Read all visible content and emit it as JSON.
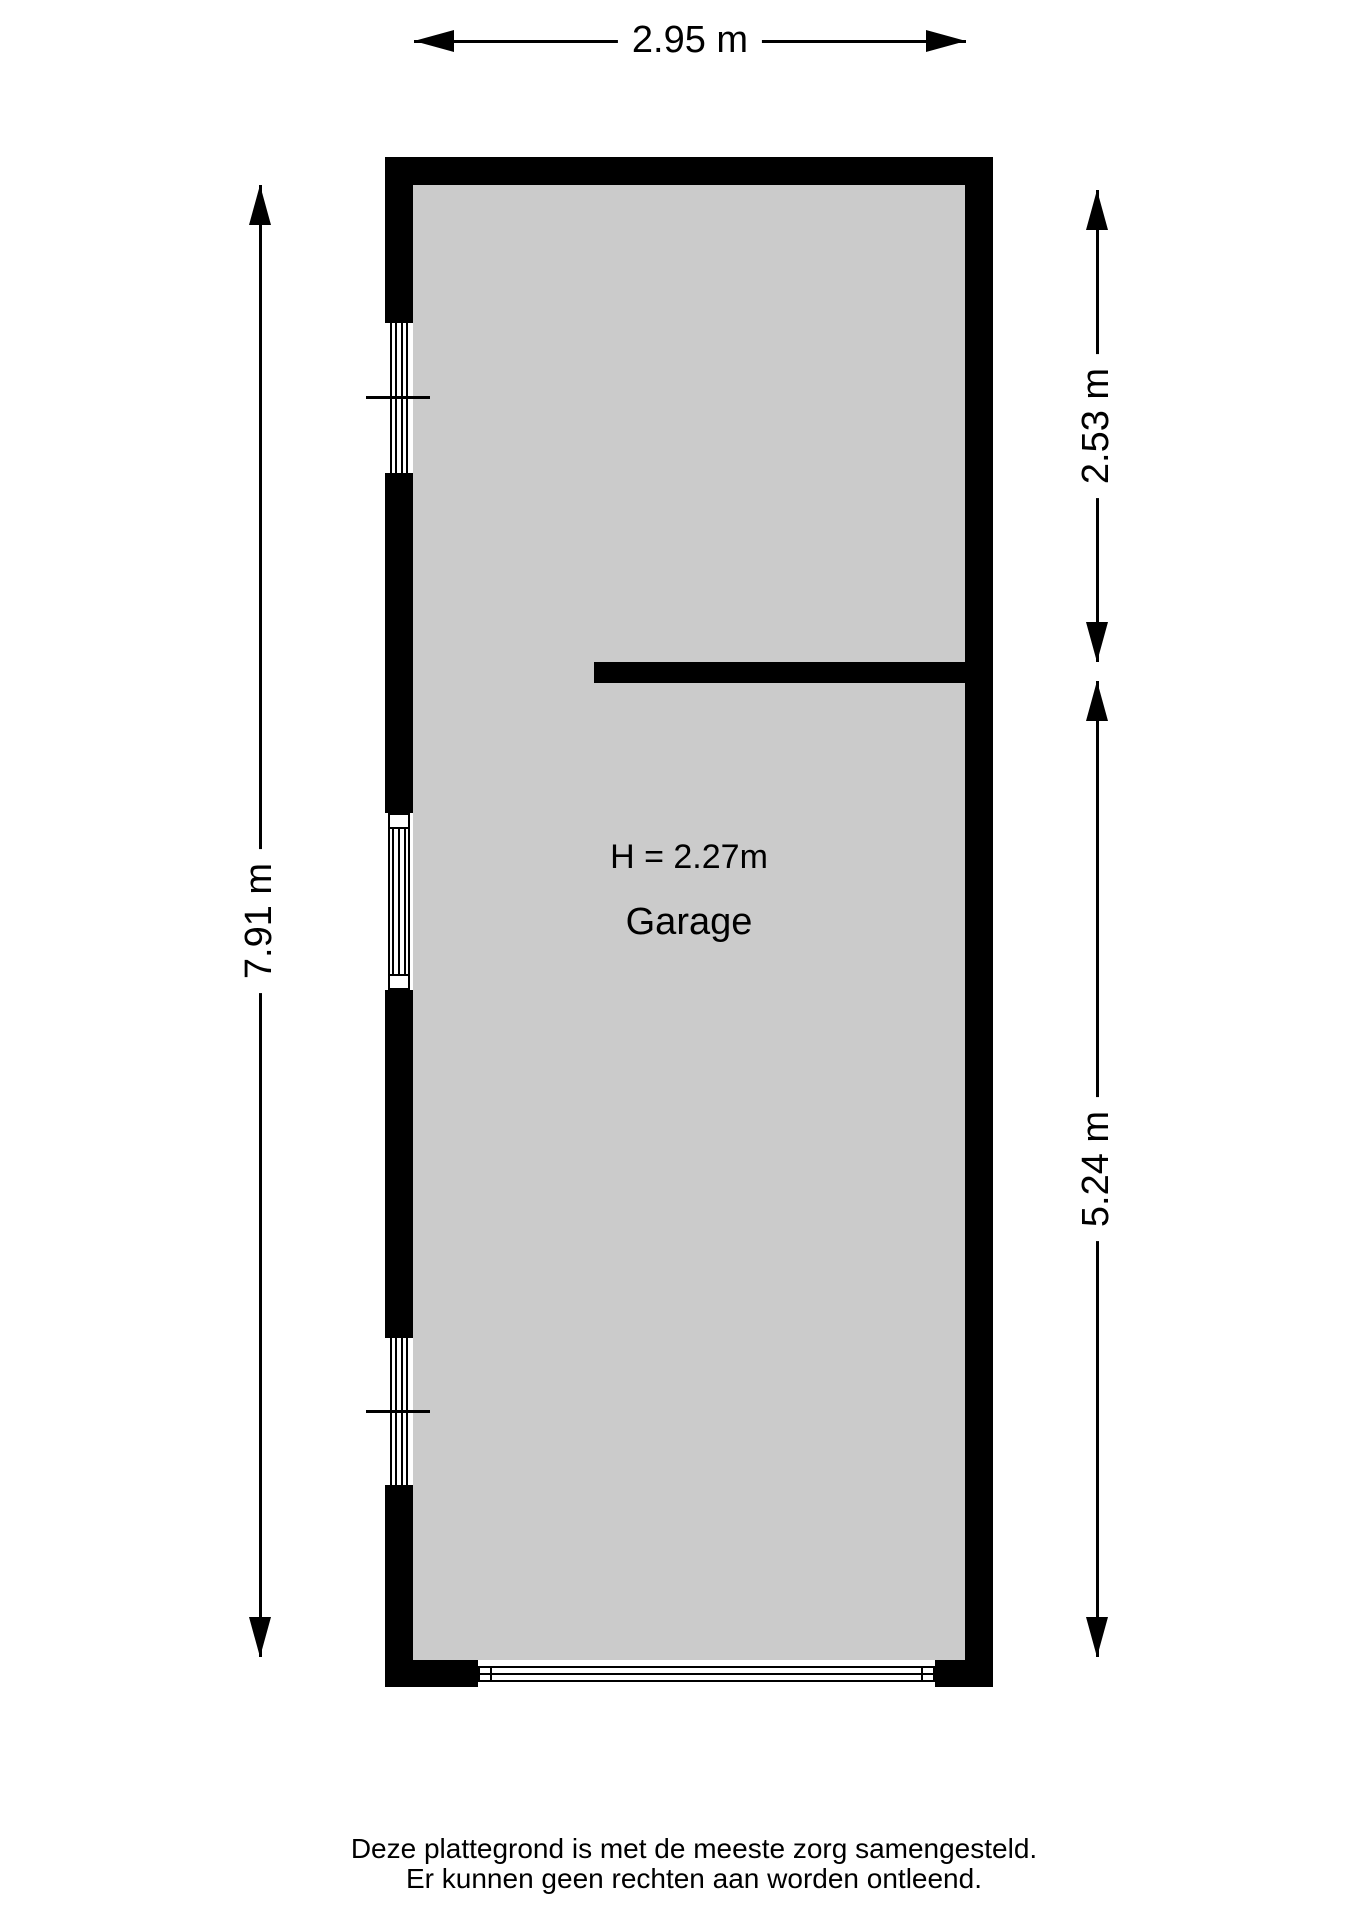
{
  "floorplan": {
    "room": {
      "name": "Garage",
      "height_label": "H = 2.27m"
    },
    "dimensions": {
      "top": "2.95 m",
      "left": "7.91 m",
      "right_upper": "2.53 m",
      "right_lower": "5.24 m"
    },
    "footer": {
      "line1": "Deze plattegrond is met de meeste zorg samengesteld.",
      "line2": "Er kunnen geen rechten aan worden ontleend."
    },
    "colors": {
      "wall": "#000000",
      "floor": "#cbcbcb",
      "background": "#ffffff"
    }
  }
}
